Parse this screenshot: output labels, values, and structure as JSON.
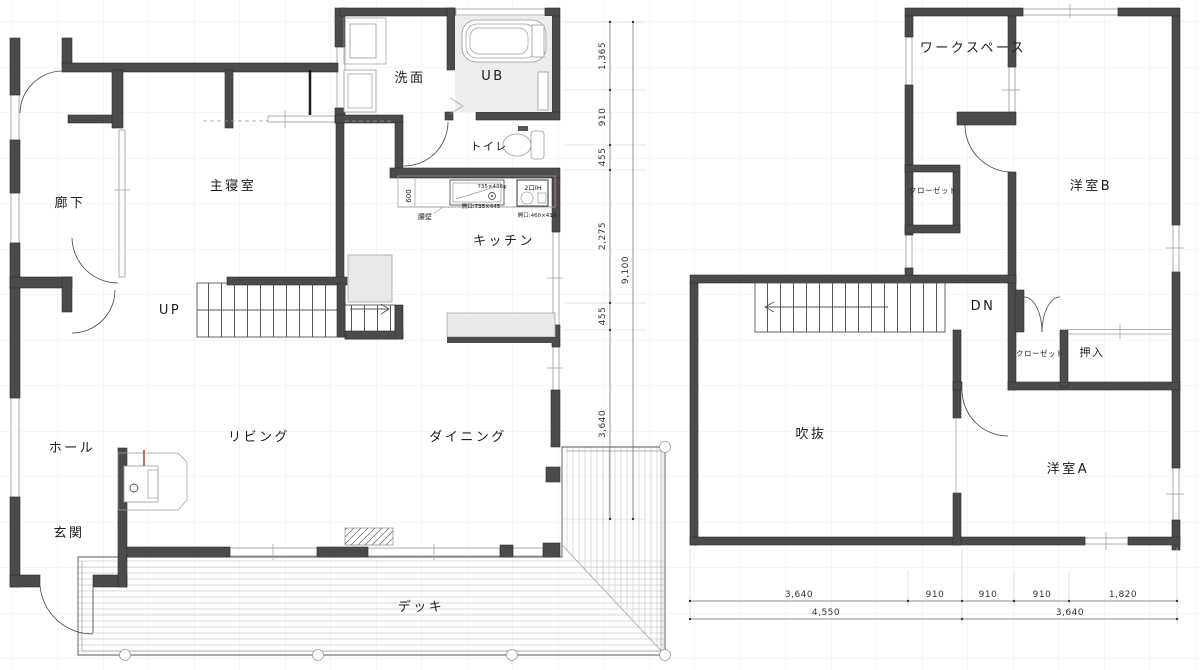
{
  "floor1": {
    "rooms": {
      "bedroom": "主寝室",
      "corridor": "廊下",
      "washroom": "洗面",
      "bath": "UB",
      "toilet": "トイレ",
      "kitchen": "キッチン",
      "living": "リビング",
      "dining": "ダイニング",
      "hall": "ホール",
      "entrance": "玄関",
      "deck": "デッキ"
    },
    "stairs_label": "UP",
    "kitchen_notes": {
      "counter_depth": "600",
      "half_wall": "腰壁",
      "sink_top": "735×436φ",
      "sink_opening": "開口:735×445",
      "ih": "2口IH",
      "ih_opening": "開口:460×410"
    }
  },
  "floor2": {
    "rooms": {
      "workspace": "ワークスペース",
      "room_b": "洋室B",
      "closet_b": "クローゼット",
      "closet_a": "クローゼット",
      "oshiire": "押入",
      "void": "吹抜",
      "room_a": "洋室A"
    },
    "stairs_label": "DN"
  },
  "dimensions": {
    "vertical_segments": [
      "1,365",
      "910",
      "455",
      "2,275",
      "455",
      "3,640"
    ],
    "vertical_total": "9,100",
    "bottom_segments": [
      "3,640",
      "910",
      "910",
      "910",
      "1,820"
    ],
    "bottom_totals": [
      "4,550",
      "3,640"
    ]
  },
  "colors": {
    "wall": "#4b4b4b",
    "accent": "#b03a2e"
  }
}
